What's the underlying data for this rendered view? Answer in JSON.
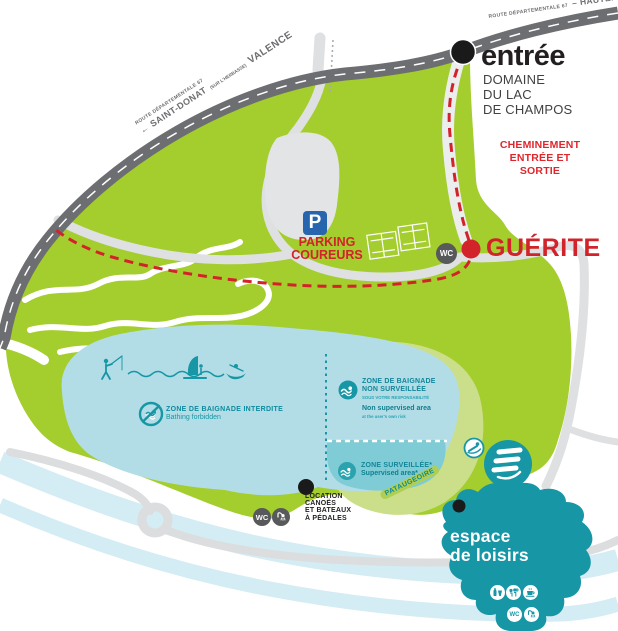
{
  "colors": {
    "park_green": "#a4cd2e",
    "pale_green": "#cbdf8b",
    "paddling_band_green": "#aecf52",
    "lake_blue": "#b2dde6",
    "supervised_blue": "#7fccd6",
    "river_blue": "#d4ecf3",
    "teal": "#1796a6",
    "road_gray": "#6d6e71",
    "path_gray": "#dfe0e1",
    "red": "#d2232a",
    "badge_gray": "#58595b",
    "parking_blue": "#2766ae",
    "text_black": "#231f20"
  },
  "roads": {
    "top": {
      "route": "ROUTE DÉPARTEMENTALE 67",
      "destination": "– HAUTERIVES"
    },
    "west": {
      "route": "ROUTE DÉPARTEMENTALE 67",
      "main": "← SAINT-DONAT",
      "detail": "(SUR L'HERBASSE)",
      "city": "VALENCE"
    }
  },
  "entrance": {
    "title": "entrée",
    "line1": "DOMAINE",
    "line2": "DU LAC",
    "line3": "DE CHAMPOS"
  },
  "cheminement": {
    "line1": "CHEMINEMENT",
    "line2": "ENTRÉE ET",
    "line3": "SORTIE"
  },
  "guerite": {
    "label": "GUÉRITE"
  },
  "parking": {
    "icon_letter": "P",
    "line1": "PARKING",
    "line2": "COUREURS"
  },
  "wc_label": "WC",
  "lake": {
    "forbidden": {
      "title": "ZONE DE BAIGNADE INTERDITE",
      "subtitle": "Bathing forbidden"
    },
    "unsupervised": {
      "line1": "ZONE DE BAIGNADE",
      "line2": "NON SURVEILLÉE",
      "line3": "SOUS VOTRE RESPONSABILITÉ",
      "line4": "Non supervised area",
      "line5": "at the user's own risk"
    },
    "supervised": {
      "line1": "ZONE SURVEILLÉE*",
      "line2": "Supervised area*"
    },
    "paddling_pool": "PATAUGEOIRE"
  },
  "rental": {
    "line1": "LOCATION",
    "line2": "CANOËS",
    "line3": "ET BATEAUX",
    "line4": "À PÉDALES"
  },
  "leisure": {
    "line1": "espace",
    "line2": "de loisirs"
  },
  "icons": {
    "entrance_marker": "black-dot",
    "guerite_marker": "red-dot",
    "activities": [
      "fisherman-icon",
      "wave-line",
      "windsurfer-icon",
      "canoe-icon"
    ],
    "zone_badges": [
      "no-swimming-icon",
      "swimmer-icon",
      "swimmer-icon"
    ],
    "waterslide": [
      "waterslide-icon",
      "slide-person-icon"
    ],
    "services": [
      "wc-icon",
      "shower-icon"
    ],
    "leisure_services": [
      "drinks-icon",
      "playground-icon",
      "cafe-icon",
      "wc-icon",
      "shower-icon"
    ]
  }
}
